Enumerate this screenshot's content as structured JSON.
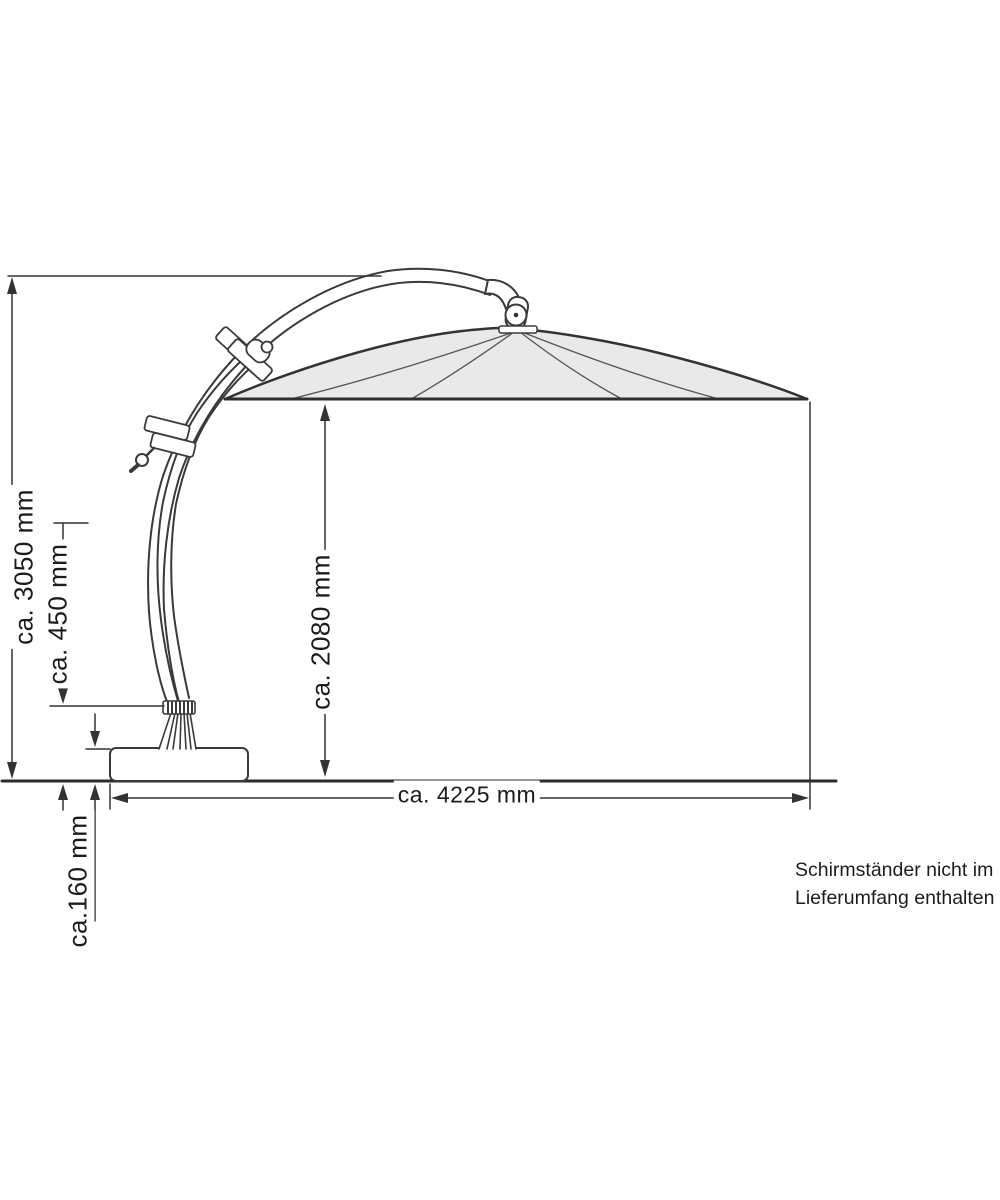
{
  "diagram": {
    "type": "cantilever-parasol-dimension-drawing",
    "labels": {
      "total_height": "ca. 3050 mm",
      "stand_clearance": "ca. 450 mm",
      "canopy_clearance": "ca. 2080 mm",
      "base_height": "ca.160 mm",
      "total_width": "ca. 4225 mm"
    },
    "note_line1": "Schirmständer nicht im",
    "note_line2": "Lieferumfang enthalten",
    "colors": {
      "line": "#333333",
      "canopy_fill": "#e9e9e9",
      "text": "#1c1c1c",
      "background": "#ffffff"
    }
  }
}
